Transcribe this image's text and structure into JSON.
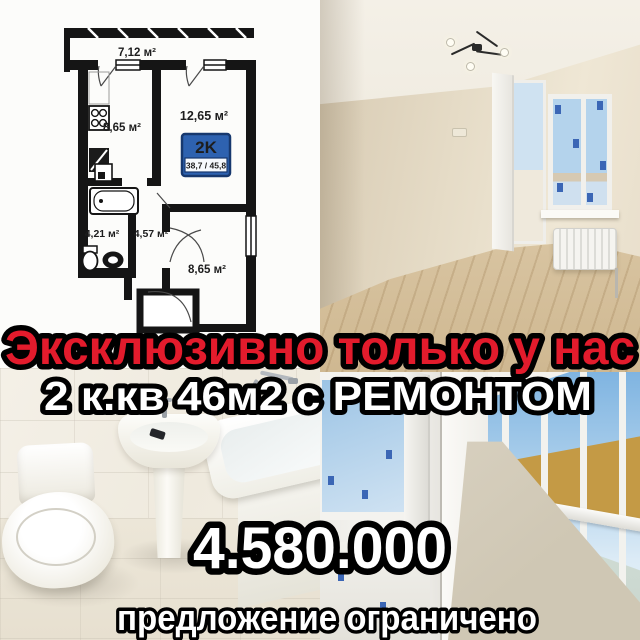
{
  "ad": {
    "headline": "Эксклюзивно только у нас",
    "subheadline": "2 к.кв 46м2 с РЕМОНТОМ",
    "price": "4.580.000",
    "footer_note": "предложение ограничено",
    "colors": {
      "headline": "#e31b2c",
      "body_text": "#ffffff",
      "outline": "#000000"
    }
  },
  "floor_plan": {
    "badge": {
      "type": "2K",
      "areas": "38,7 / 45,8",
      "bg_color": "#2e62b0",
      "text_color": "#ffffff",
      "areas_text_color": "#12264d"
    },
    "rooms": {
      "balcony": "7,12 м²",
      "kitchen": "8,65 м²",
      "living_room": "12,65 м²",
      "bathroom": "4,21 м²",
      "hallway": "4,57 м²",
      "bedroom": "8,65 м²"
    }
  }
}
